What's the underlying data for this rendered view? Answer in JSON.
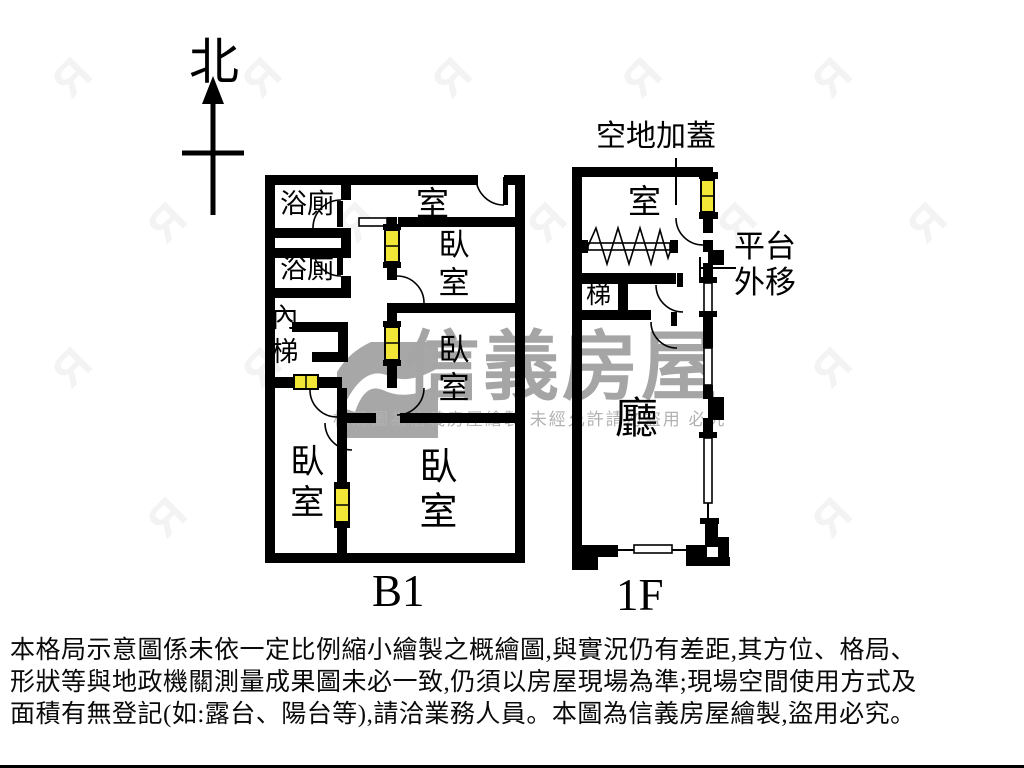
{
  "compass": {
    "north_label": "北"
  },
  "b1": {
    "floor_label": "B1",
    "bath_top": "浴廁",
    "bath_bottom": "浴廁",
    "inner_stairs": "內梯",
    "room_top": "室",
    "bedroom_upper_right": "臥室",
    "bedroom_mid_right": "臥室",
    "bedroom_bottom_left": "臥室",
    "bedroom_bottom_right": "臥室"
  },
  "f1": {
    "floor_label": "1F",
    "room_top": "室",
    "stairs": "梯",
    "living_room": "廳",
    "annotation_rooftop": "空地加蓋",
    "annotation_platform_line1": "平台",
    "annotation_platform_line2": "外移"
  },
  "watermark": {
    "brand": "信義房屋",
    "notice": "格局圖為信義房屋繪製 未經允許請勿盜用 必究"
  },
  "disclaimer": {
    "line1": "本格局示意圖係未依一定比例縮小繪製之概繪圖,與實況仍有差距,其方位、格局、",
    "line2": "形狀等與地政機關測量成果圖未必一致,仍須以房屋現場為準;現場空間使用方式及",
    "line3": "面積有無登記(如:露台、陽台等),請洽業務人員。本圖為信義房屋繪製,盜用必究。"
  },
  "colors": {
    "wall": "#000000",
    "window_yellow": "#f2e636",
    "watermark_gray": "#a5a5a5"
  }
}
